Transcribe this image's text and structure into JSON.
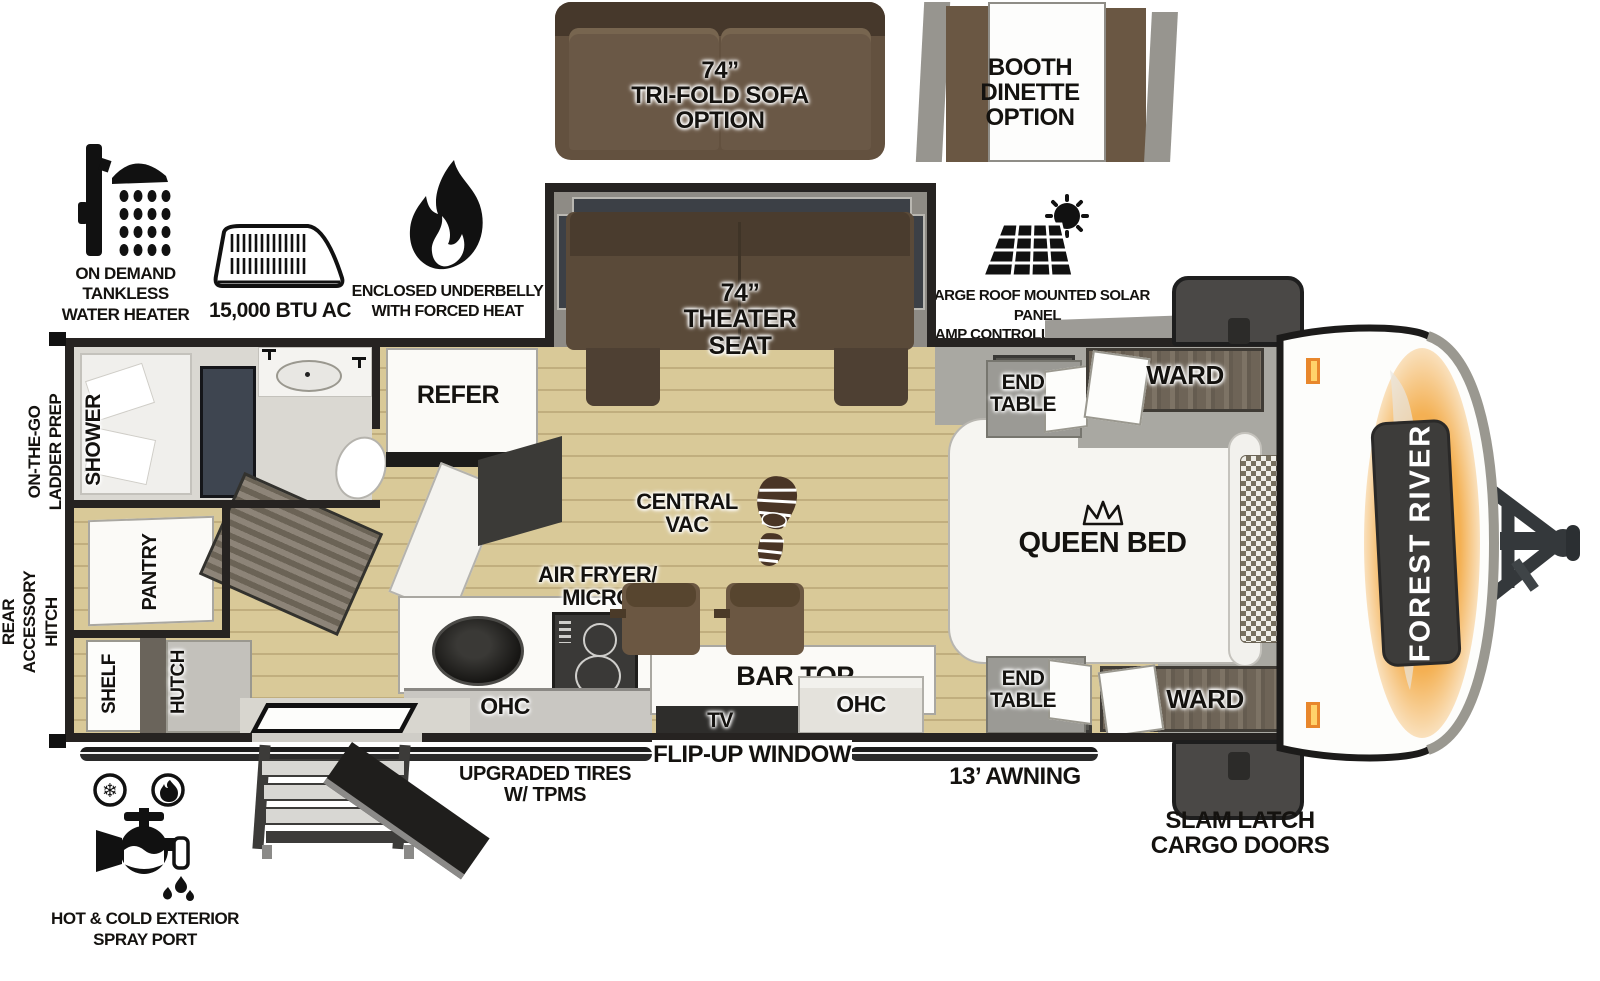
{
  "options": {
    "trifold_sofa_label": "74”\nTRI-FOLD SOFA\nOPTION",
    "booth_dinette_label": "BOOTH\nDINETTE\nOPTION"
  },
  "features": {
    "water_heater": "ON DEMAND\nTANKLESS\nWATER HEATER",
    "ac_unit": "15,000 BTU AC",
    "underbelly": "ENCLOSED UNDERBELLY\nWITH FORCED HEAT",
    "solar_panel": "LARGE ROOF MOUNTED SOLAR PANEL\n30 AMP CONTROLLER & INVERTER PREP",
    "upgraded_tires": "UPGRADED TIRES\nW/ TPMS",
    "flip_up_window": "FLIP-UP WINDOW",
    "awning": "13’ AWNING",
    "slam_latch": "SLAM LATCH\nCARGO DOORS",
    "spray_port": "HOT & COLD EXTERIOR\nSPRAY PORT",
    "ladder_prep": "ON-THE-GO\nLADDER PREP",
    "rear_hitch": "REAR\nACCESSORY\nHITCH"
  },
  "interior": {
    "theater_seat": "74”\nTHEATER\nSEAT",
    "refer": "REFER",
    "shower": "SHOWER",
    "pantry": "PANTRY",
    "shelf": "SHELF",
    "hutch": "HUTCH",
    "central_vac": "CENTRAL\nVAC",
    "air_fryer_micro": "AIR FRYER/\nMICRO",
    "bar_top": "BAR TOP",
    "tv": "TV",
    "ohc_kitchen": "OHC",
    "ohc_bedroom": "OHC",
    "queen_bed": "QUEEN BED",
    "end_table_top": "END\nTABLE",
    "end_table_bottom": "END\nTABLE",
    "ward_top": "WARD",
    "ward_bottom": "WARD"
  },
  "branding": {
    "front_cap_badge": "FOREST RIVER"
  },
  "colors": {
    "wall": "#262321",
    "floor_tan": "#d9c998",
    "sofa_brown": "#5f4e3c",
    "accent_orange": "#f09d3c",
    "cabinet_gray": "#b9b7b1",
    "dark_door": "#3e4550"
  }
}
